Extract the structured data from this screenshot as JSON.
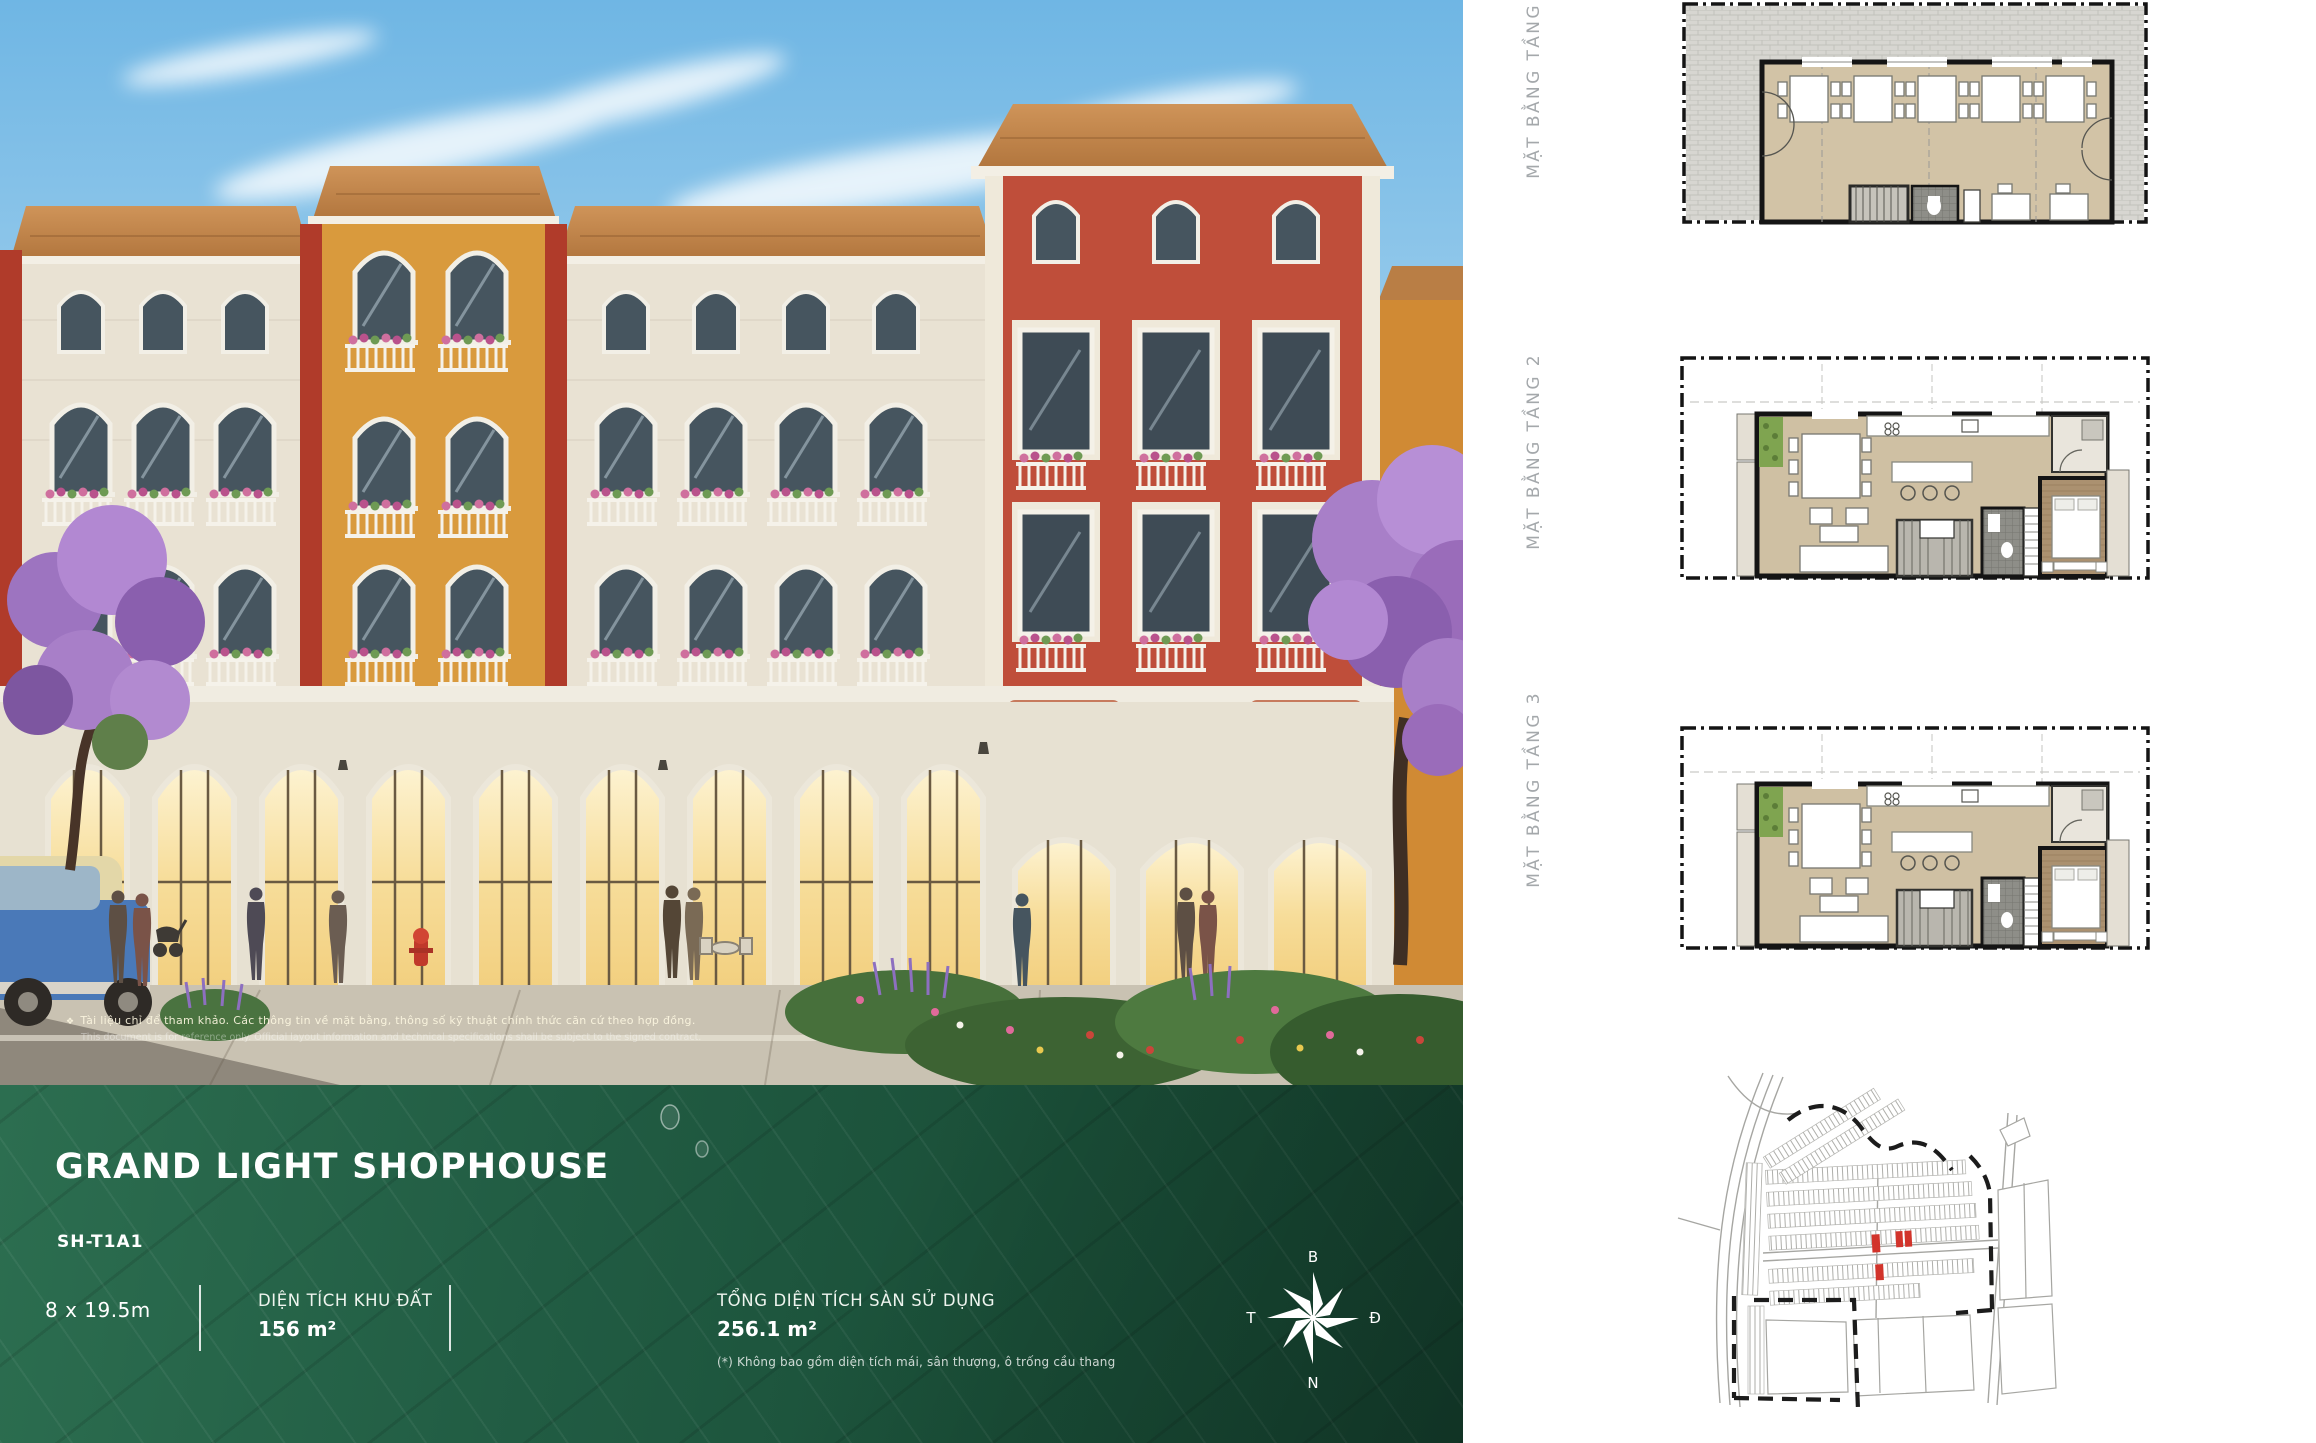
{
  "hero": {
    "signs": {
      "left": "THE SHOW",
      "right": "MAMBO"
    },
    "disclaimer_vi": "Tài liệu chỉ để tham khảo. Các thông tin về mặt bằng, thông số kỹ thuật chính thức căn cứ theo hợp đồng.",
    "disclaimer_en": "This document is for reference only. Official layout information and technical specifications shall be subject to the signed contract."
  },
  "icons": {
    "bullet": "❖"
  },
  "info_panel": {
    "title": "GRAND LIGHT SHOPHOUSE",
    "unit_code": "SH-T1A1",
    "lot_size": "8 x 19.5m",
    "land_area_label": "DIỆN TÍCH KHU ĐẤT",
    "land_area_value": "156 m²",
    "gfa_label": "TỔNG DIỆN TÍCH SÀN SỬ DỤNG",
    "gfa_value": "256.1 m²",
    "gfa_note": "(*) Không bao gồm diện tích mái, sân thượng, ô trống cầu thang",
    "compass": {
      "north_label": "B",
      "east_label": "Đ",
      "south_label": "N",
      "west_label": "T"
    }
  },
  "floor_plans": [
    {
      "label": "MẶT BẰNG TẦNG 1"
    },
    {
      "label": "MẶT BẰNG TẦNG 2"
    },
    {
      "label": "MẶT BẰNG TẦNG 3"
    }
  ],
  "colors": {
    "panel_green": "#1e5740",
    "facade_red": "#bf4e3a",
    "facade_orange": "#d99a3d",
    "facade_cream": "#e9e2d3",
    "roof_terracotta": "#c08047",
    "map_highlight_red": "#d2342b",
    "plan_label_gray": "#a4a8ab",
    "sky_blue": "#7fc0e9"
  }
}
